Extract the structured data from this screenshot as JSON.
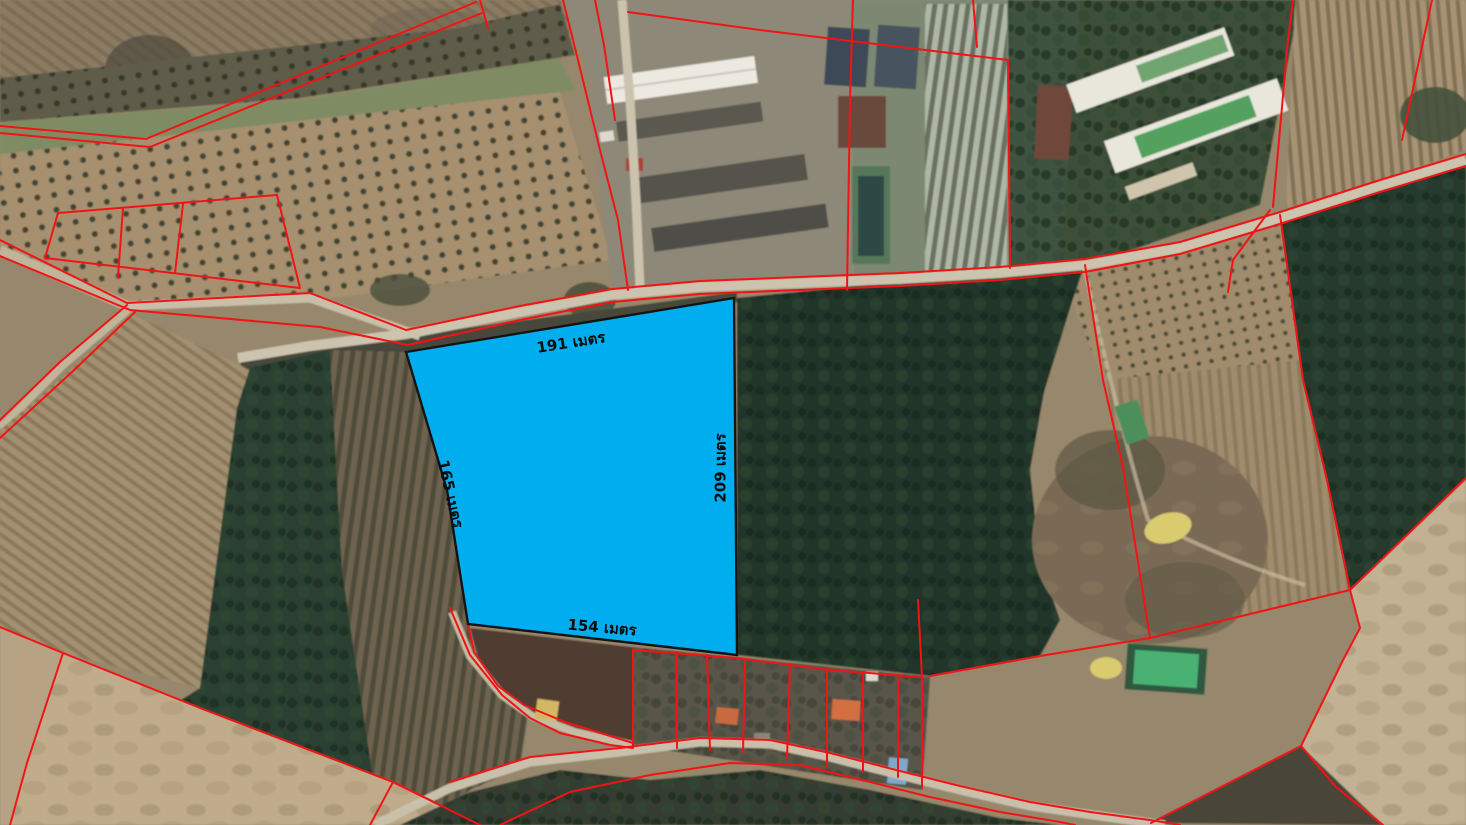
{
  "map": {
    "kind": "satellite-imagery-with-cadastral-overlay",
    "overlay": {
      "parcel_boundary_color": "#f21414",
      "highlight_parcel": {
        "fill": "#00aeef",
        "stroke": "#141414",
        "points": "406,352 734,298 737,655 468,624 447,490",
        "side_labels": [
          {
            "side": "top",
            "text": "191 เมตร",
            "value": 191,
            "unit": "เมตร",
            "x": 571,
            "y": 343,
            "rotation": -9
          },
          {
            "side": "left",
            "text": "165 เมตร",
            "value": 165,
            "unit": "เมตร",
            "x": 450,
            "y": 494,
            "rotation": 77
          },
          {
            "side": "right",
            "text": "209 เมตร",
            "value": 209,
            "unit": "เมตร",
            "x": 721,
            "y": 468,
            "rotation": -90
          },
          {
            "side": "bottom",
            "text": "154 เมตร",
            "value": 154,
            "unit": "เมตร",
            "x": 602,
            "y": 628,
            "rotation": 5
          }
        ]
      }
    }
  }
}
